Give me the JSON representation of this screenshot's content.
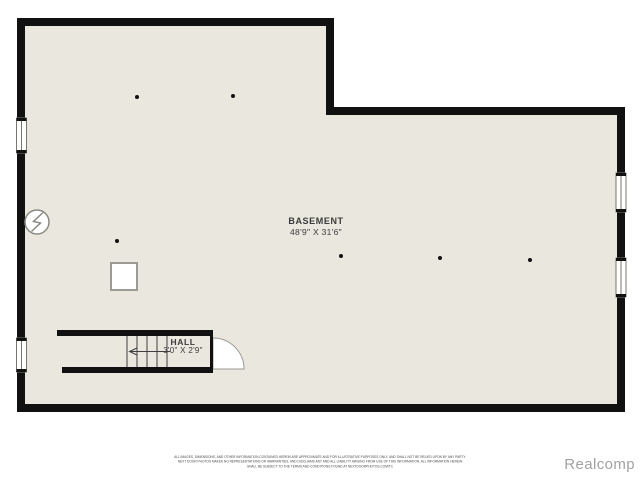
{
  "plan": {
    "basement": {
      "name": "BASEMENT",
      "dims": "48'9\" X 31'6\""
    },
    "hall": {
      "name": "HALL",
      "dims": "3'0\" X 2'9\""
    }
  },
  "colors": {
    "wall": "#111111",
    "floor": "#e9e7de",
    "label": "#3a3a3a",
    "watermark": "#a2a2a2"
  },
  "symbols": {
    "electrical_panel": "electrical-panel-icon",
    "window_count": 4,
    "door_count": 1,
    "stairway_count": 1,
    "support_column_count": 6,
    "utility_box_count": 1
  },
  "disclaimer": {
    "line1": "ALL IMAGES, DIMENSIONS, AND OTHER INFORMATION CONTAINED HEREIN ARE APPROXIMATE AND FOR ILLUSTRATIVE PURPOSES ONLY, AND SHALL NOT BE RELIED UPON BY ANY PARTY.",
    "line2": "NEXT DOOR PHOTOS MAKES NO REPRESENTATIONS OR WARRANTIES, AND DISCLAIMS ANY AND ALL LIABILITY ARISING FROM USE OF THIS INFORMATION. ALL INFORMATION HEREIN",
    "line3": "SHALL BE SUBJECT TO THE TERMS AND CONDITIONS FOUND AT NEXTDOORPHOTOS.COM/TC"
  },
  "watermark": "Realcomp"
}
